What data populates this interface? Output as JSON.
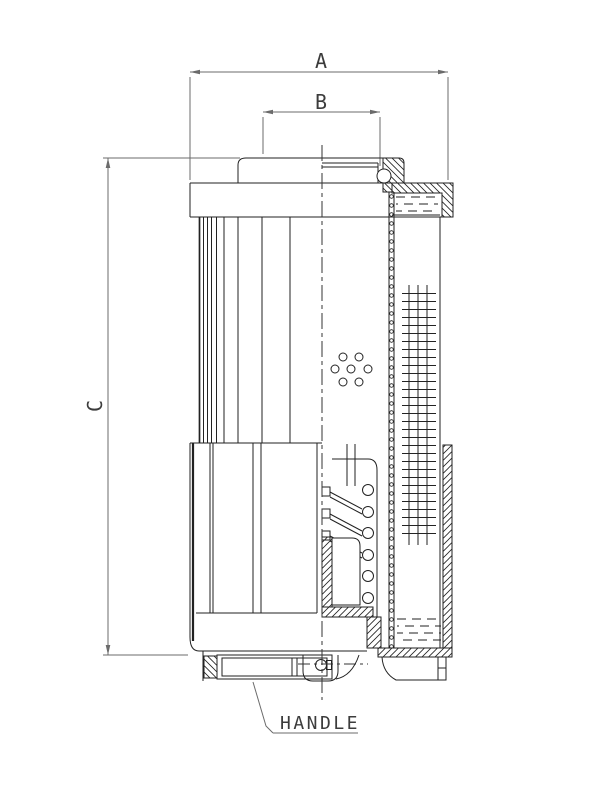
{
  "drawing": {
    "title": "filter-element-section-drawing",
    "dimensions": {
      "a": "A",
      "b": "B",
      "c": "C"
    },
    "callouts": {
      "handle": "HANDLE"
    },
    "colors": {
      "line": "#222222",
      "dimension": "#6b6b6b",
      "centerline": "#333333",
      "text": "#3c3c3c",
      "background": "#ffffff"
    }
  }
}
